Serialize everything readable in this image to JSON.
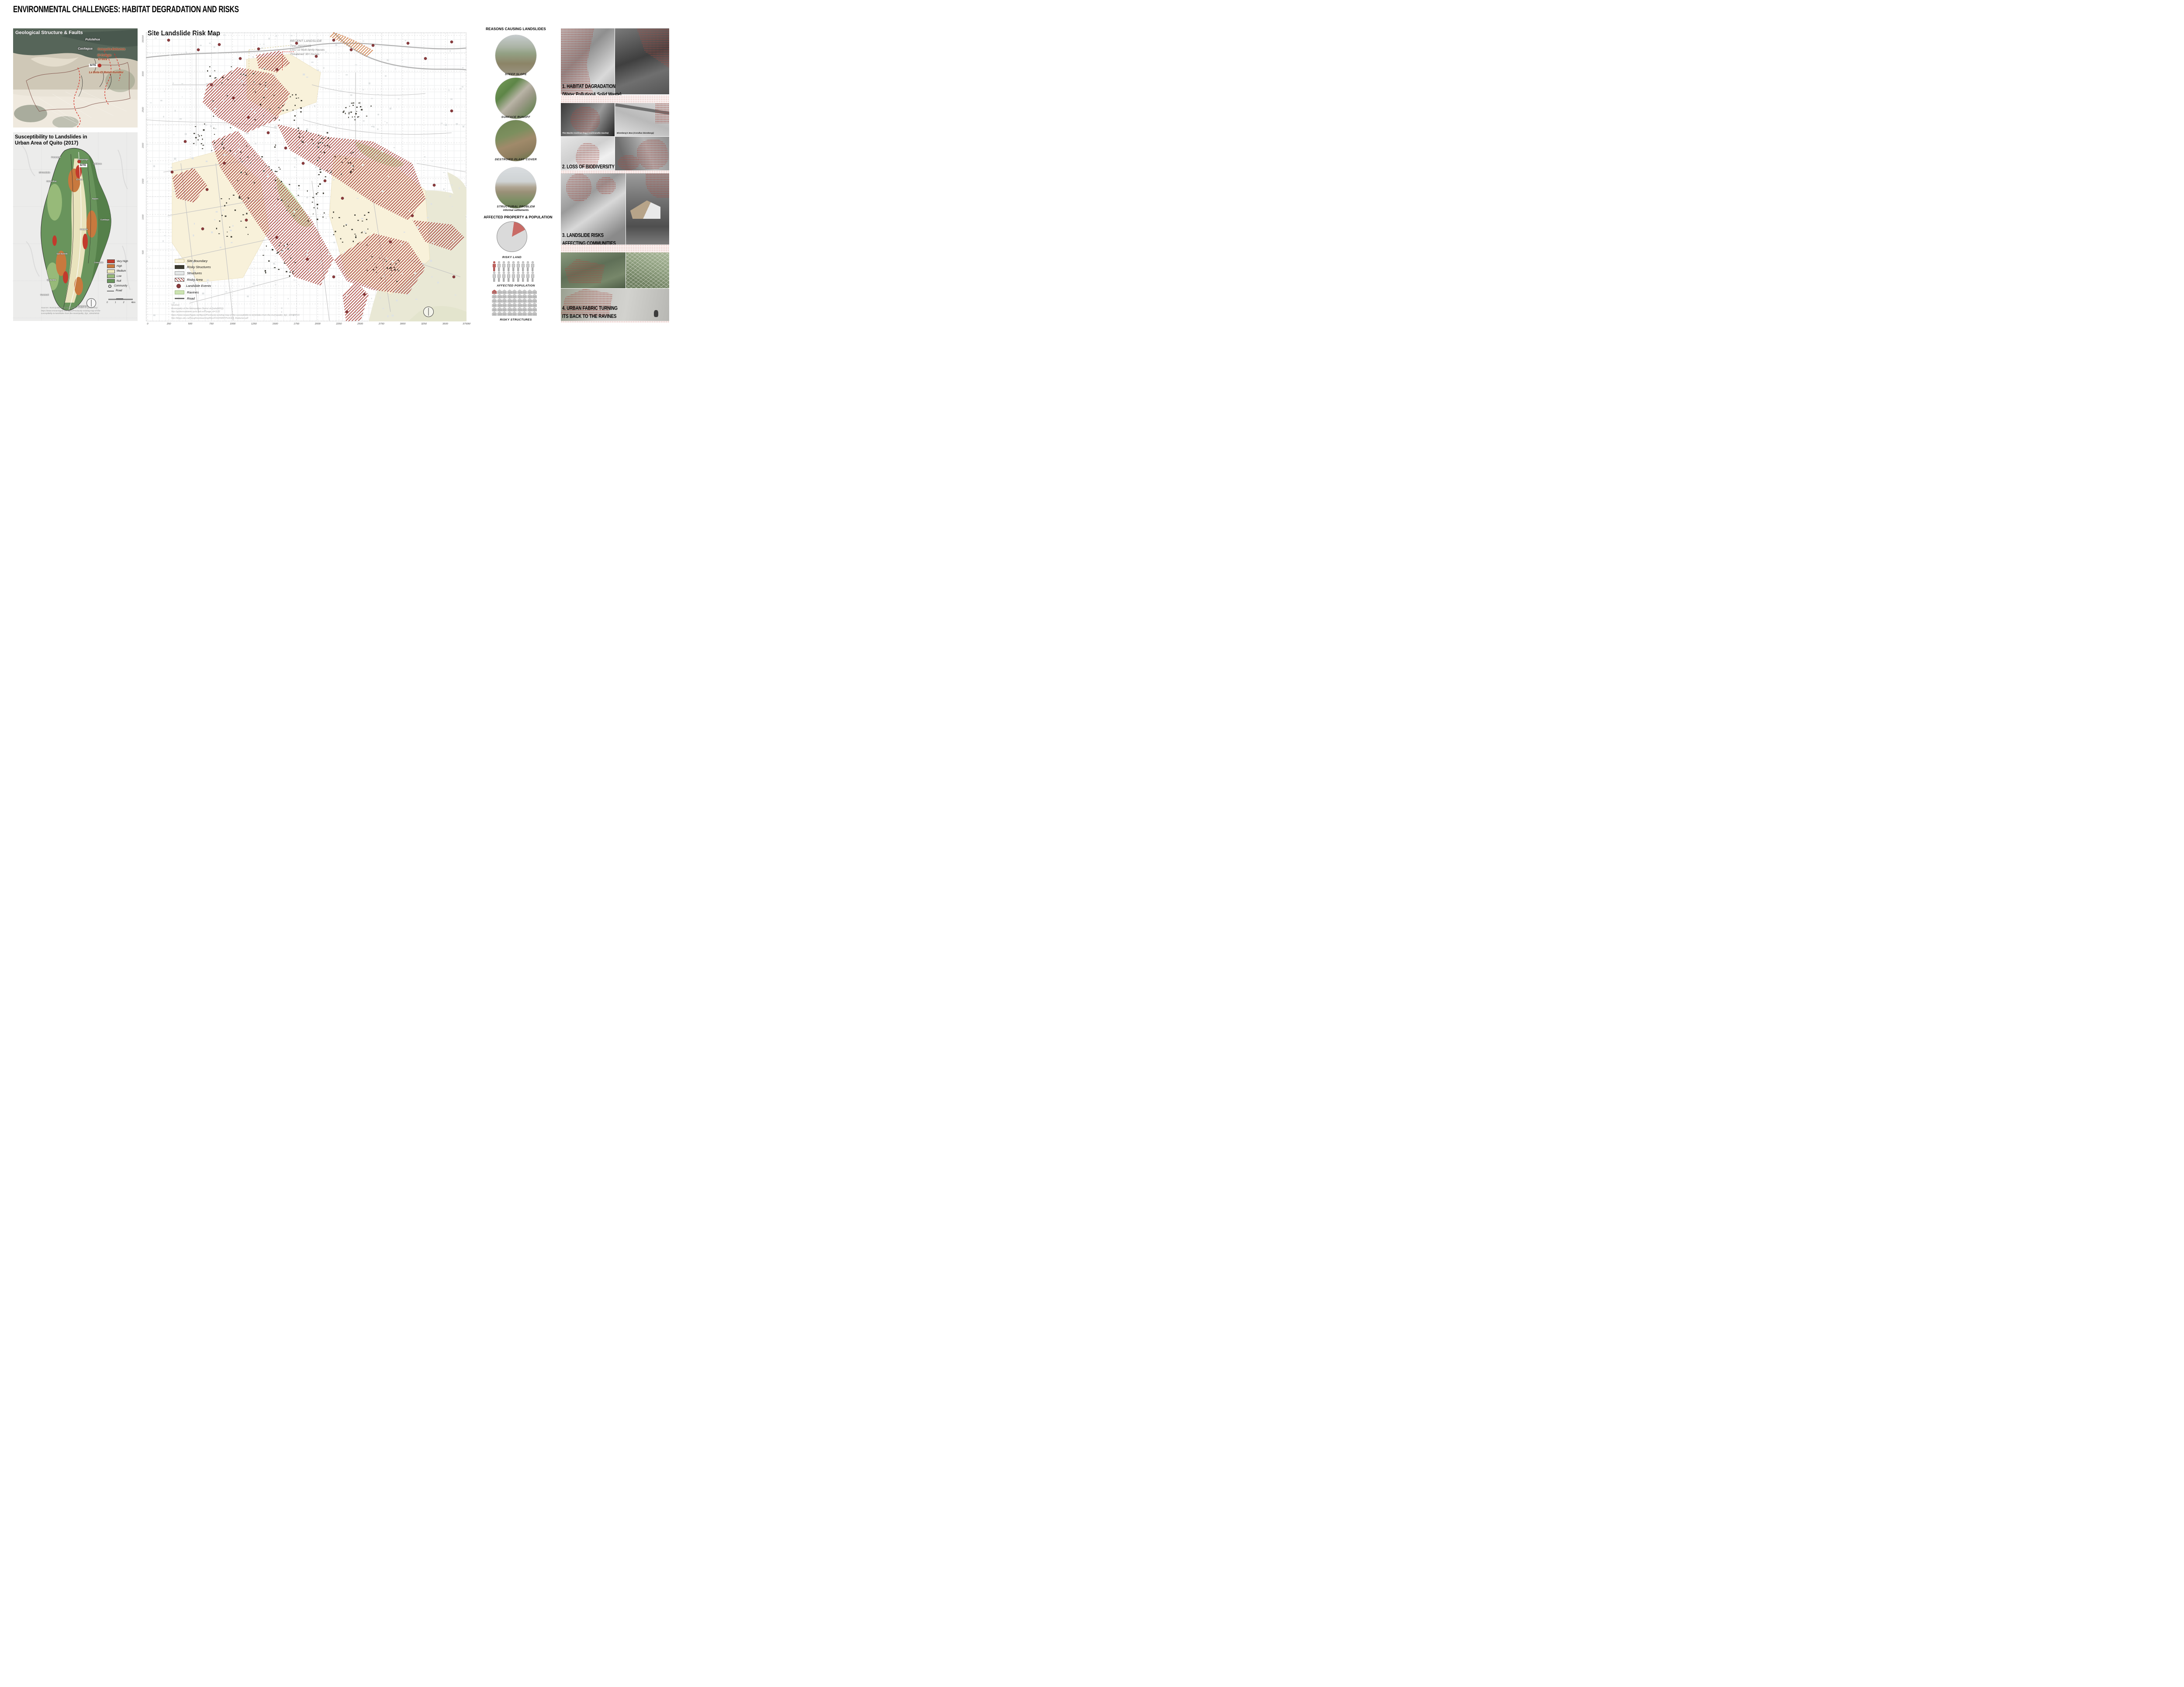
{
  "poster_title": "ENVIRONMENTAL CHALLENGES: HABITAT DEGRADATION AND RISKS",
  "geological": {
    "title": "Geological Structure & Faults",
    "labels": [
      {
        "text": "Pululahua",
        "x": 182,
        "y": 26,
        "style": "white"
      },
      {
        "text": "Casitagua",
        "x": 165,
        "y": 47,
        "style": "white"
      },
      {
        "text": "Catequilla Bellavista",
        "x": 225,
        "y": 48,
        "style": "red"
      },
      {
        "text": "El Colegio",
        "x": 209,
        "y": 62,
        "style": "red"
      },
      {
        "text": "El Inca",
        "x": 205,
        "y": 71,
        "style": "red"
      },
      {
        "text": "La Bota-El Batan-Ilumbisi",
        "x": 213,
        "y": 101,
        "style": "red"
      }
    ],
    "site_label": "SITE"
  },
  "susceptibility": {
    "title_line1": "Susceptibility to Landslides in",
    "title_line2": "Urban Area of Quito (2017)",
    "site_label": "SITE",
    "legend": [
      {
        "label": "Very High",
        "type": "swatch",
        "color": "#c23a2c"
      },
      {
        "label": "High",
        "type": "swatch",
        "color": "#c8793e"
      },
      {
        "label": "Medium",
        "type": "swatch",
        "color": "#eee8ba"
      },
      {
        "label": "Low",
        "type": "swatch",
        "color": "#97ba79"
      },
      {
        "label": "Null",
        "type": "swatch",
        "color": "#69945c"
      },
      {
        "label": "Community",
        "type": "circledot"
      },
      {
        "label": "Road",
        "type": "line"
      }
    ],
    "scale_labels": [
      "0",
      "1",
      "2",
      "4km"
    ],
    "sources_lines": [
      "Sources: Municipality of the Metropolitan District of Quito(MDQ)",
      "https://www.researchgate.net/figure/Previously-existing-map-of-the-",
      "susceptibility-to-landslides-from-the-municipality_fig1_326425016"
    ],
    "communities": [
      {
        "text": "Pomasqui",
        "x": 98,
        "y": 57
      },
      {
        "text": "Carapungo",
        "x": 160,
        "y": 62
      },
      {
        "text": "Calderon",
        "x": 193,
        "y": 72
      },
      {
        "text": "El Condado",
        "x": 72,
        "y": 92
      },
      {
        "text": "Cotocollao",
        "x": 88,
        "y": 112
      },
      {
        "text": "El Inca",
        "x": 152,
        "y": 108
      },
      {
        "text": "Nayon",
        "x": 188,
        "y": 152
      },
      {
        "text": "Cumbaya",
        "x": 210,
        "y": 200
      },
      {
        "text": "Guapulo",
        "x": 162,
        "y": 222
      },
      {
        "text": "San Bartolo",
        "x": 112,
        "y": 278
      },
      {
        "text": "Conocoto",
        "x": 196,
        "y": 298
      },
      {
        "text": "Quitumbe",
        "x": 88,
        "y": 338
      },
      {
        "text": "Guamani",
        "x": 72,
        "y": 372
      },
      {
        "text": "Amaguana",
        "x": 158,
        "y": 398
      }
    ]
  },
  "risk_map": {
    "title": "Site Landslide Risk Map",
    "annotation": {
      "title": "RECENT LANDSLIDE",
      "time": "Time: 2021/03/03",
      "loss": "Loss: 12 Multi-family Houses",
      "threatened": "Threatened: 90+ houses"
    },
    "y_ticks": [
      "3500M",
      "3000",
      "2500",
      "2000",
      "1500",
      "1000",
      "500"
    ],
    "x_ticks": [
      "0",
      "250",
      "500",
      "750",
      "1000",
      "1250",
      "1500",
      "1750",
      "2000",
      "2250",
      "2500",
      "2750",
      "3000",
      "3250",
      "3500",
      "3750M"
    ],
    "legend": [
      {
        "label": "Site Boundary",
        "type": "swatch",
        "color": "#f8f1da",
        "border": "#cfc49a"
      },
      {
        "label": "Risky Structures",
        "type": "swatch",
        "color": "#3b3a31",
        "border": "#3b3a31"
      },
      {
        "label": "Structures",
        "type": "swatch",
        "color": "#e4e7e7",
        "border": "#9a9a9a"
      },
      {
        "label": "Risky Area",
        "type": "hatch"
      },
      {
        "label": "Landslide Events",
        "type": "dot",
        "color": "#8a3a3c"
      },
      {
        "label": "Ravines",
        "type": "swatch",
        "color": "#cde4b2",
        "border": "#9ab77f"
      },
      {
        "label": "Road",
        "type": "line",
        "color": "#6e6e6e"
      }
    ],
    "sources_lines": [
      "Sources:",
      "Municipality of the Metropolitan District of Quito(MDQ)",
      "http://gobiernoabierto.quito.gob.ec/?page_id=1122",
      "https://www.researchgate.net/figure/Previously-existing-map-of-the-susceptibility-to-landslides-from-the-municipality_fig1_326425016",
      "http://blogs.ubc.ca/thoughtsonteaching/files/2016/09/MYPLACE4_Redacted.pdf"
    ],
    "landslide_events_xy": [
      [
        52,
        18
      ],
      [
        120,
        40
      ],
      [
        168,
        28
      ],
      [
        216,
        60
      ],
      [
        258,
        38
      ],
      [
        300,
        85
      ],
      [
        345,
        25
      ],
      [
        390,
        55
      ],
      [
        430,
        18
      ],
      [
        470,
        40
      ],
      [
        520,
        30
      ],
      [
        600,
        25
      ],
      [
        640,
        60
      ],
      [
        700,
        22
      ],
      [
        150,
        120
      ],
      [
        200,
        150
      ],
      [
        235,
        195
      ],
      [
        280,
        230
      ],
      [
        320,
        265
      ],
      [
        360,
        300
      ],
      [
        410,
        340
      ],
      [
        450,
        380
      ],
      [
        180,
        300
      ],
      [
        140,
        360
      ],
      [
        230,
        430
      ],
      [
        300,
        470
      ],
      [
        370,
        520
      ],
      [
        430,
        560
      ],
      [
        500,
        600
      ],
      [
        560,
        480
      ],
      [
        610,
        420
      ],
      [
        660,
        350
      ],
      [
        700,
        180
      ],
      [
        130,
        450
      ],
      [
        460,
        640
      ],
      [
        705,
        560
      ],
      [
        90,
        250
      ],
      [
        60,
        320
      ]
    ]
  },
  "reasons": {
    "title": "REASONS CAUSING LANDSLIDES",
    "items": [
      {
        "label": "STEEP SLOPE"
      },
      {
        "label": "SURFACE RUNOFF"
      },
      {
        "label": "DESTROIED PLANT COVER"
      },
      {
        "label": "STRUCTURAL PROBLEM",
        "sublabel": "informal settlements"
      }
    ]
  },
  "affected": {
    "title": "AFFECTED PROPERTY & POPULATION",
    "pie": {
      "caption": "RISKY LAND",
      "start_deg": 8,
      "slices": [
        {
          "name": "risky land",
          "pct": 15,
          "color": "#c96b66"
        },
        {
          "name": "other land",
          "pct": 85,
          "color": "#dadada"
        }
      ]
    },
    "population": {
      "caption": "AFFECTED POPULATION",
      "rows": 2,
      "cols": 9,
      "highlighted": 1
    },
    "structures": {
      "caption": "RISKY STRUCTURES",
      "rows": 6,
      "cols": 9,
      "highlighted": 1
    }
  },
  "findings": [
    {
      "line1": "1. HABITAT DAGRADATION",
      "line2": "(Water Pollution& Solid Waste)"
    },
    {
      "line1": "2. LOSS OF BIODIVERSITY",
      "line2": "",
      "captions": {
        "tl": "The Mache Cochran frog ( Cochranella mache)",
        "tr": "Blomberg's Boa (Corallus blombergi)",
        "bl": "Ecuadorian brown-headed spider monkey",
        "br": "The Great Green Macaw"
      }
    },
    {
      "line1": "3. LANDSLIDE RISKS",
      "line2": "AFFECTING COMMUNITIES"
    },
    {
      "line1": "4. URBAN FABRIC TURNING",
      "line2": "ITS BACK TO THE RAVINES"
    }
  ],
  "chart_data": [
    {
      "type": "pie",
      "title": "RISKY LAND",
      "slices": [
        {
          "label": "risky land",
          "pct": 15
        },
        {
          "label": "other land",
          "pct": 85
        }
      ],
      "legend_position": "none"
    },
    {
      "type": "pictograph",
      "title": "AFFECTED POPULATION",
      "total": 18,
      "highlighted": 1
    },
    {
      "type": "pictograph",
      "title": "RISKY STRUCTURES",
      "total": 54,
      "highlighted": 1
    }
  ],
  "colors": {
    "risk_accent": "#a8423a",
    "landslide_dot": "#8a3a3c",
    "site_boundary": "#f8f1da",
    "ravines": "#cde4b2",
    "very_high": "#c23a2c",
    "high": "#c8793e",
    "medium": "#eee8ba",
    "low": "#97ba79",
    "null": "#69945c"
  }
}
